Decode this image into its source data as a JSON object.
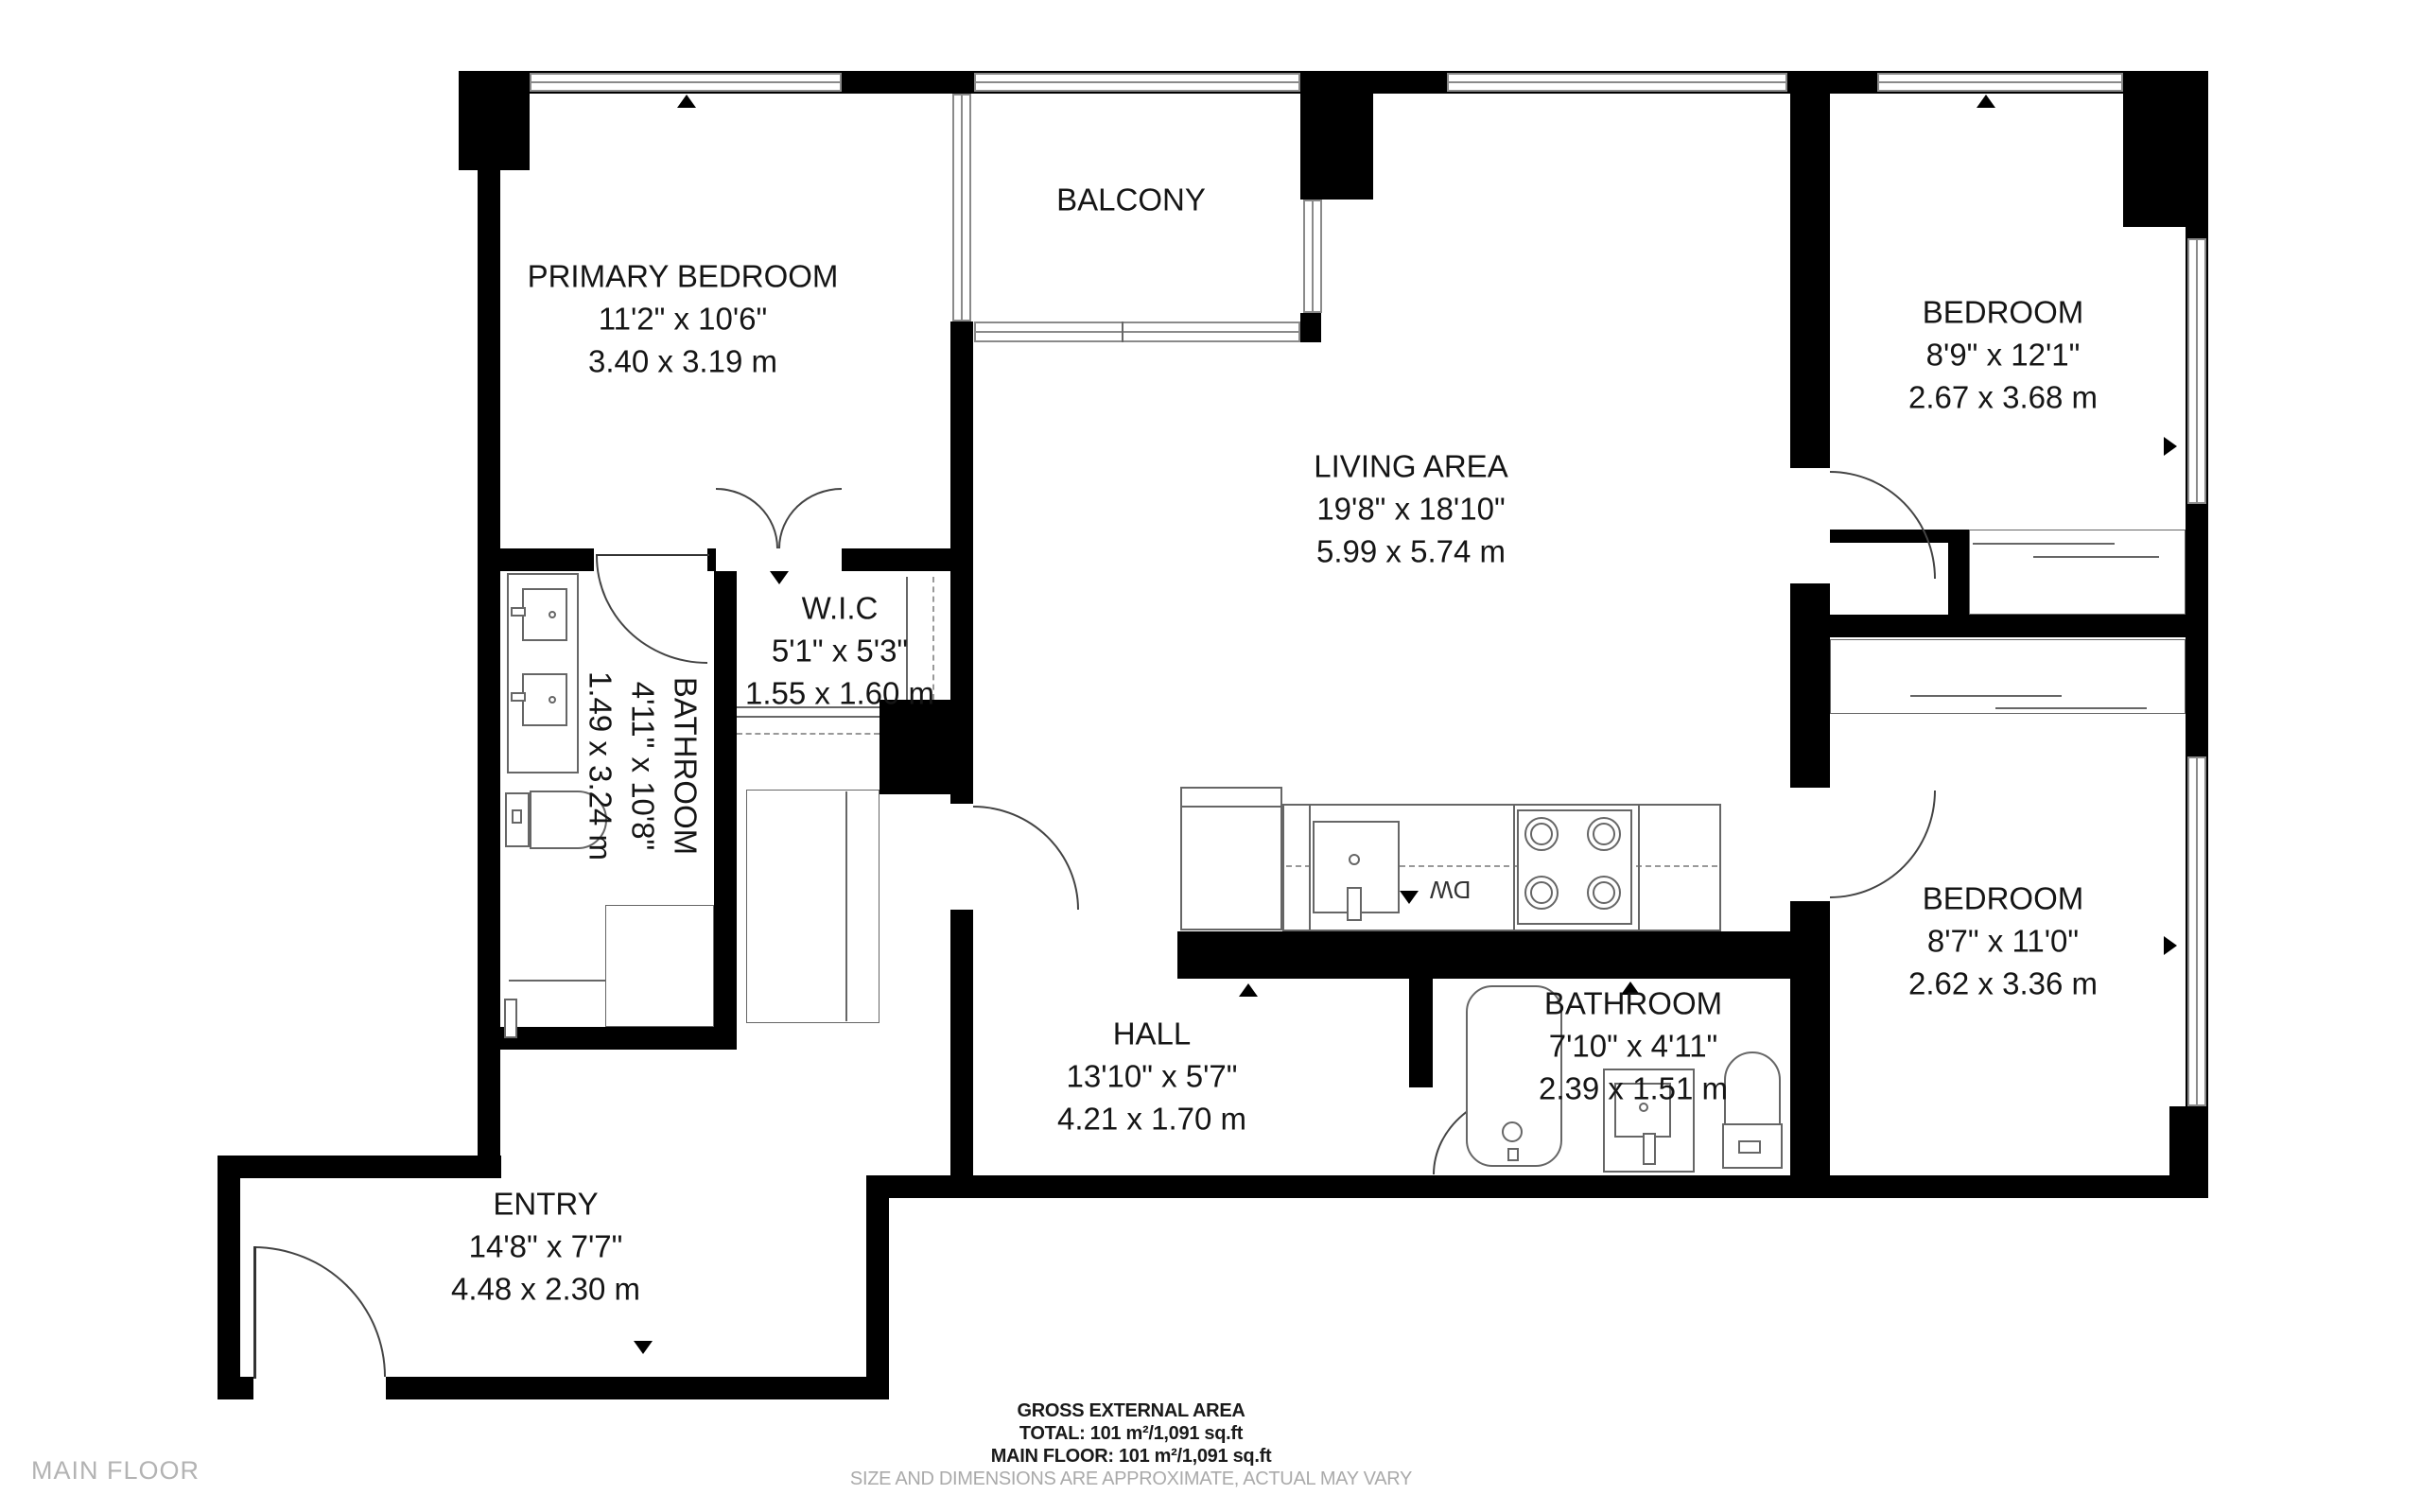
{
  "meta": {
    "floor_label": "MAIN FLOOR"
  },
  "rooms": {
    "primary_bedroom": {
      "name": "PRIMARY BEDROOM",
      "imperial": "11'2\" x 10'6\"",
      "metric": "3.40 x 3.19 m"
    },
    "balcony": {
      "name": "BALCONY"
    },
    "living_area": {
      "name": "LIVING AREA",
      "imperial": "19'8\" x 18'10\"",
      "metric": "5.99 x 5.74 m"
    },
    "bedroom_top_right": {
      "name": "BEDROOM",
      "imperial": "8'9\" x 12'1\"",
      "metric": "2.67 x 3.68 m"
    },
    "wic": {
      "name": "W.I.C",
      "imperial": "5'1\" x 5'3\"",
      "metric": "1.55 x 1.60 m"
    },
    "bathroom_ensuite": {
      "name": "BATHROOM",
      "imperial": "4'11\" x 10'8\"",
      "metric": "1.49 x 3.24 m"
    },
    "hall": {
      "name": "HALL",
      "imperial": "13'10\" x 5'7\"",
      "metric": "4.21 x 1.70 m"
    },
    "bathroom_main": {
      "name": "BATHROOM",
      "imperial": "7'10\" x 4'11\"",
      "metric": "2.39 x 1.51 m"
    },
    "bedroom_bottom_right": {
      "name": "BEDROOM",
      "imperial": "8'7\" x 11'0\"",
      "metric": "2.62 x 3.36 m"
    },
    "entry": {
      "name": "ENTRY",
      "imperial": "14'8\" x 7'7\"",
      "metric": "4.48 x 2.30 m"
    }
  },
  "kitchen": {
    "dishwasher_label": "DW"
  },
  "footer": {
    "title": "GROSS EXTERNAL AREA",
    "total": "TOTAL: 101 m²/1,091 sq.ft",
    "main_floor": "MAIN FLOOR: 101 m²/1,091 sq.ft",
    "disclaimer": "SIZE AND DIMENSIONS ARE APPROXIMATE, ACTUAL MAY VARY"
  }
}
